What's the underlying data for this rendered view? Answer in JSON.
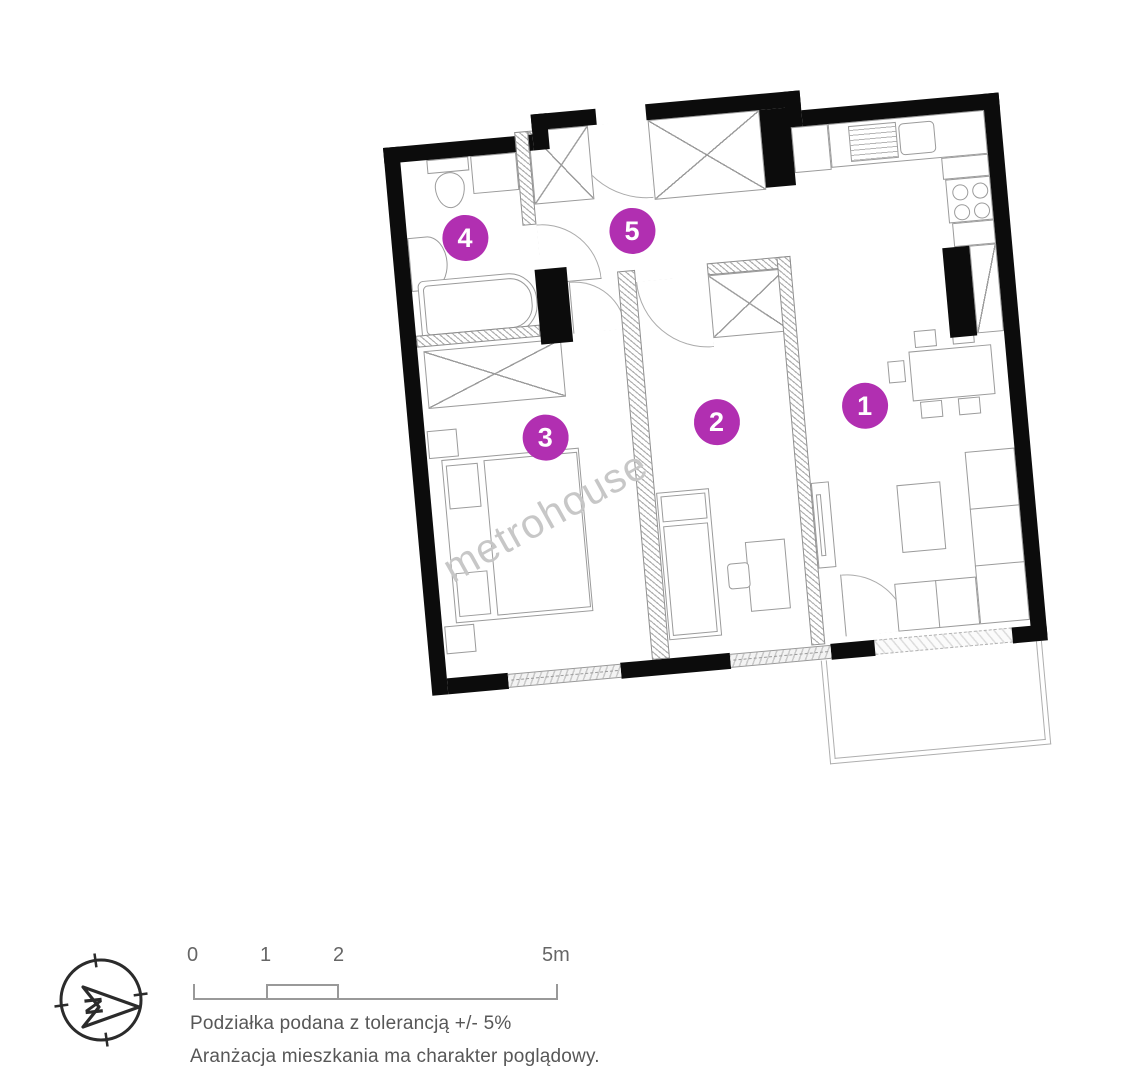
{
  "plan": {
    "watermark": "metrohouse",
    "rooms": [
      {
        "number": "1"
      },
      {
        "number": "2"
      },
      {
        "number": "3"
      },
      {
        "number": "4"
      },
      {
        "number": "5"
      }
    ]
  },
  "legend": {
    "compass_letter": "N",
    "scale": {
      "labels": [
        "0",
        "1",
        "2",
        "5m"
      ]
    },
    "note1": "Podziałka podana z tolerancją +/- 5%",
    "note2": "Aranżacja mieszkania ma charakter poglądowy."
  },
  "colors": {
    "accent": "#b12fb1",
    "wall": "#0c0c0c",
    "line": "#9b9b9b",
    "watermark": "#c7c7c7"
  }
}
